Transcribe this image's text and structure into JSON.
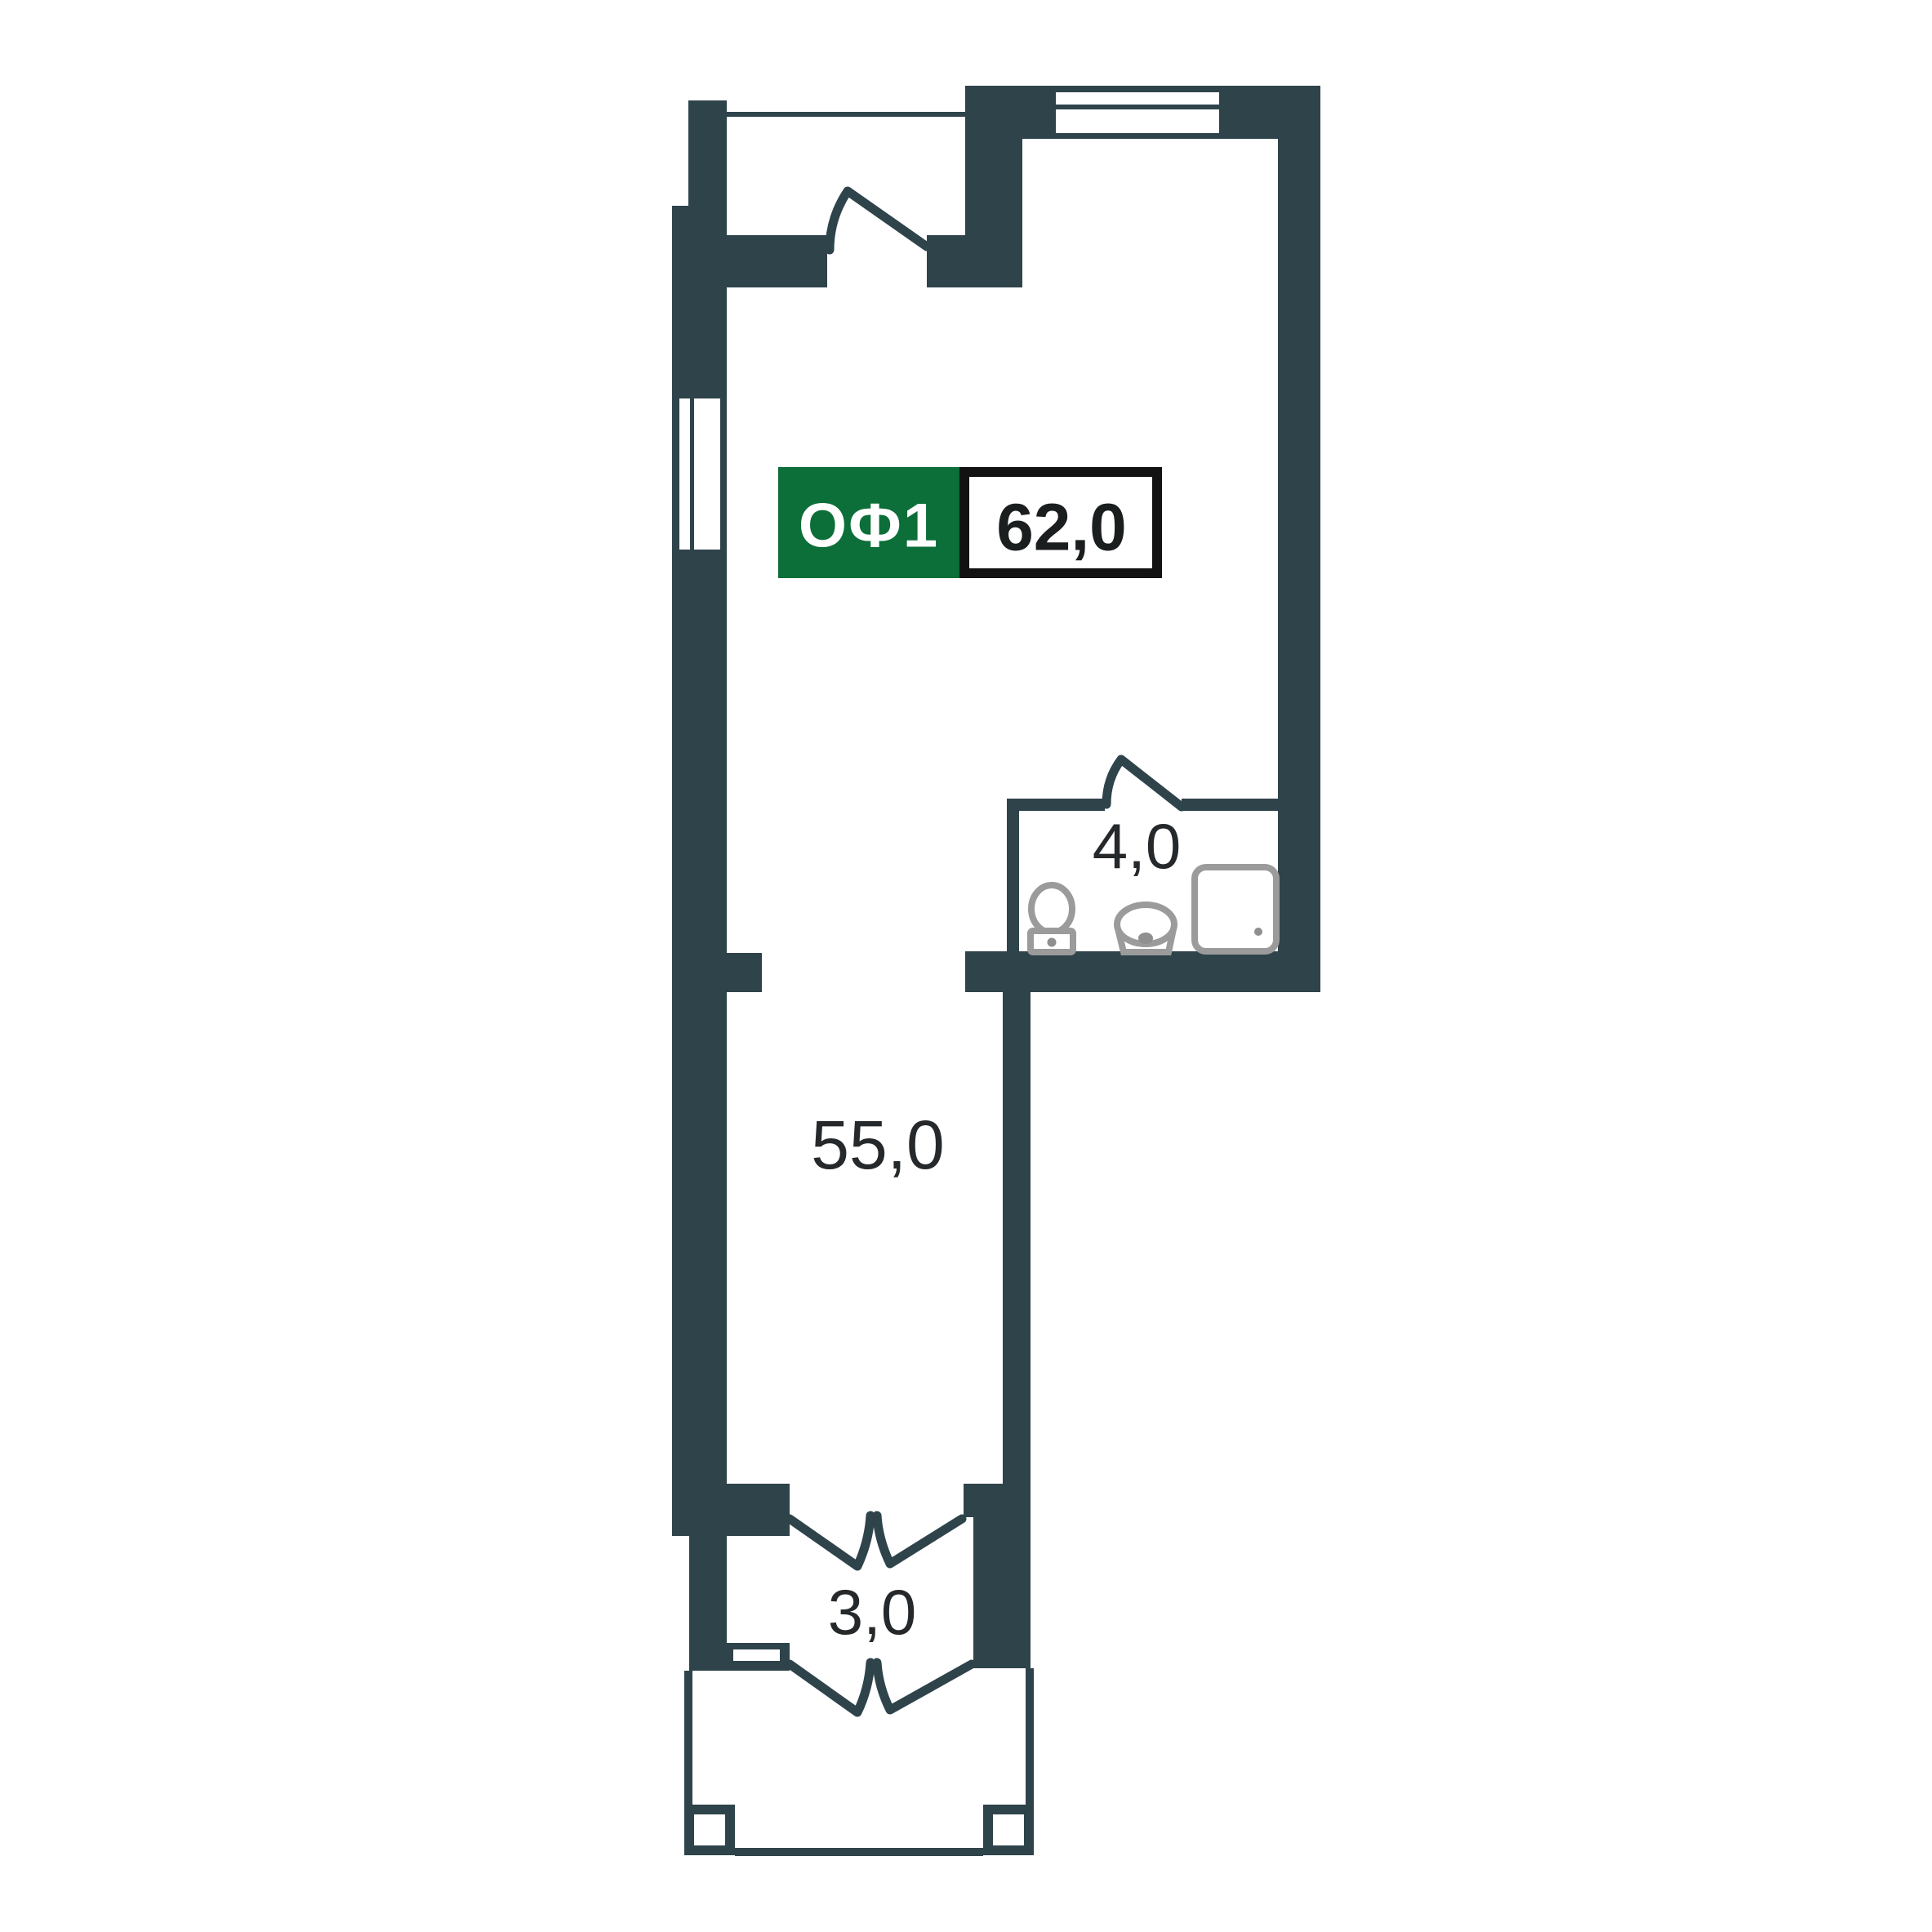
{
  "title": "Commercial unit floor plan",
  "badge": {
    "unit_label": "ОФ1",
    "total_area": "62,0"
  },
  "rooms": [
    {
      "name": "main-office-room",
      "area": "55,0"
    },
    {
      "name": "bathroom",
      "area": "4,0"
    },
    {
      "name": "entrance-hall",
      "area": "3,0"
    }
  ],
  "icons": {
    "window": "window-icon",
    "door": "door-swing-icon",
    "toilet": "toilet-icon",
    "sink": "sink-icon",
    "shower": "shower-tray-icon",
    "column": "porch-column-icon"
  },
  "colors": {
    "background": "#ffffff",
    "wall": "#2f434b",
    "accent_green": "#0c6e38",
    "badge_border": "#121212",
    "badge_text": "#1b1e1f",
    "area_text": "#26292b",
    "fixture_gray": "#9b9b9b",
    "fixture_gray_dark": "#8f8f8f",
    "white": "#ffffff"
  }
}
